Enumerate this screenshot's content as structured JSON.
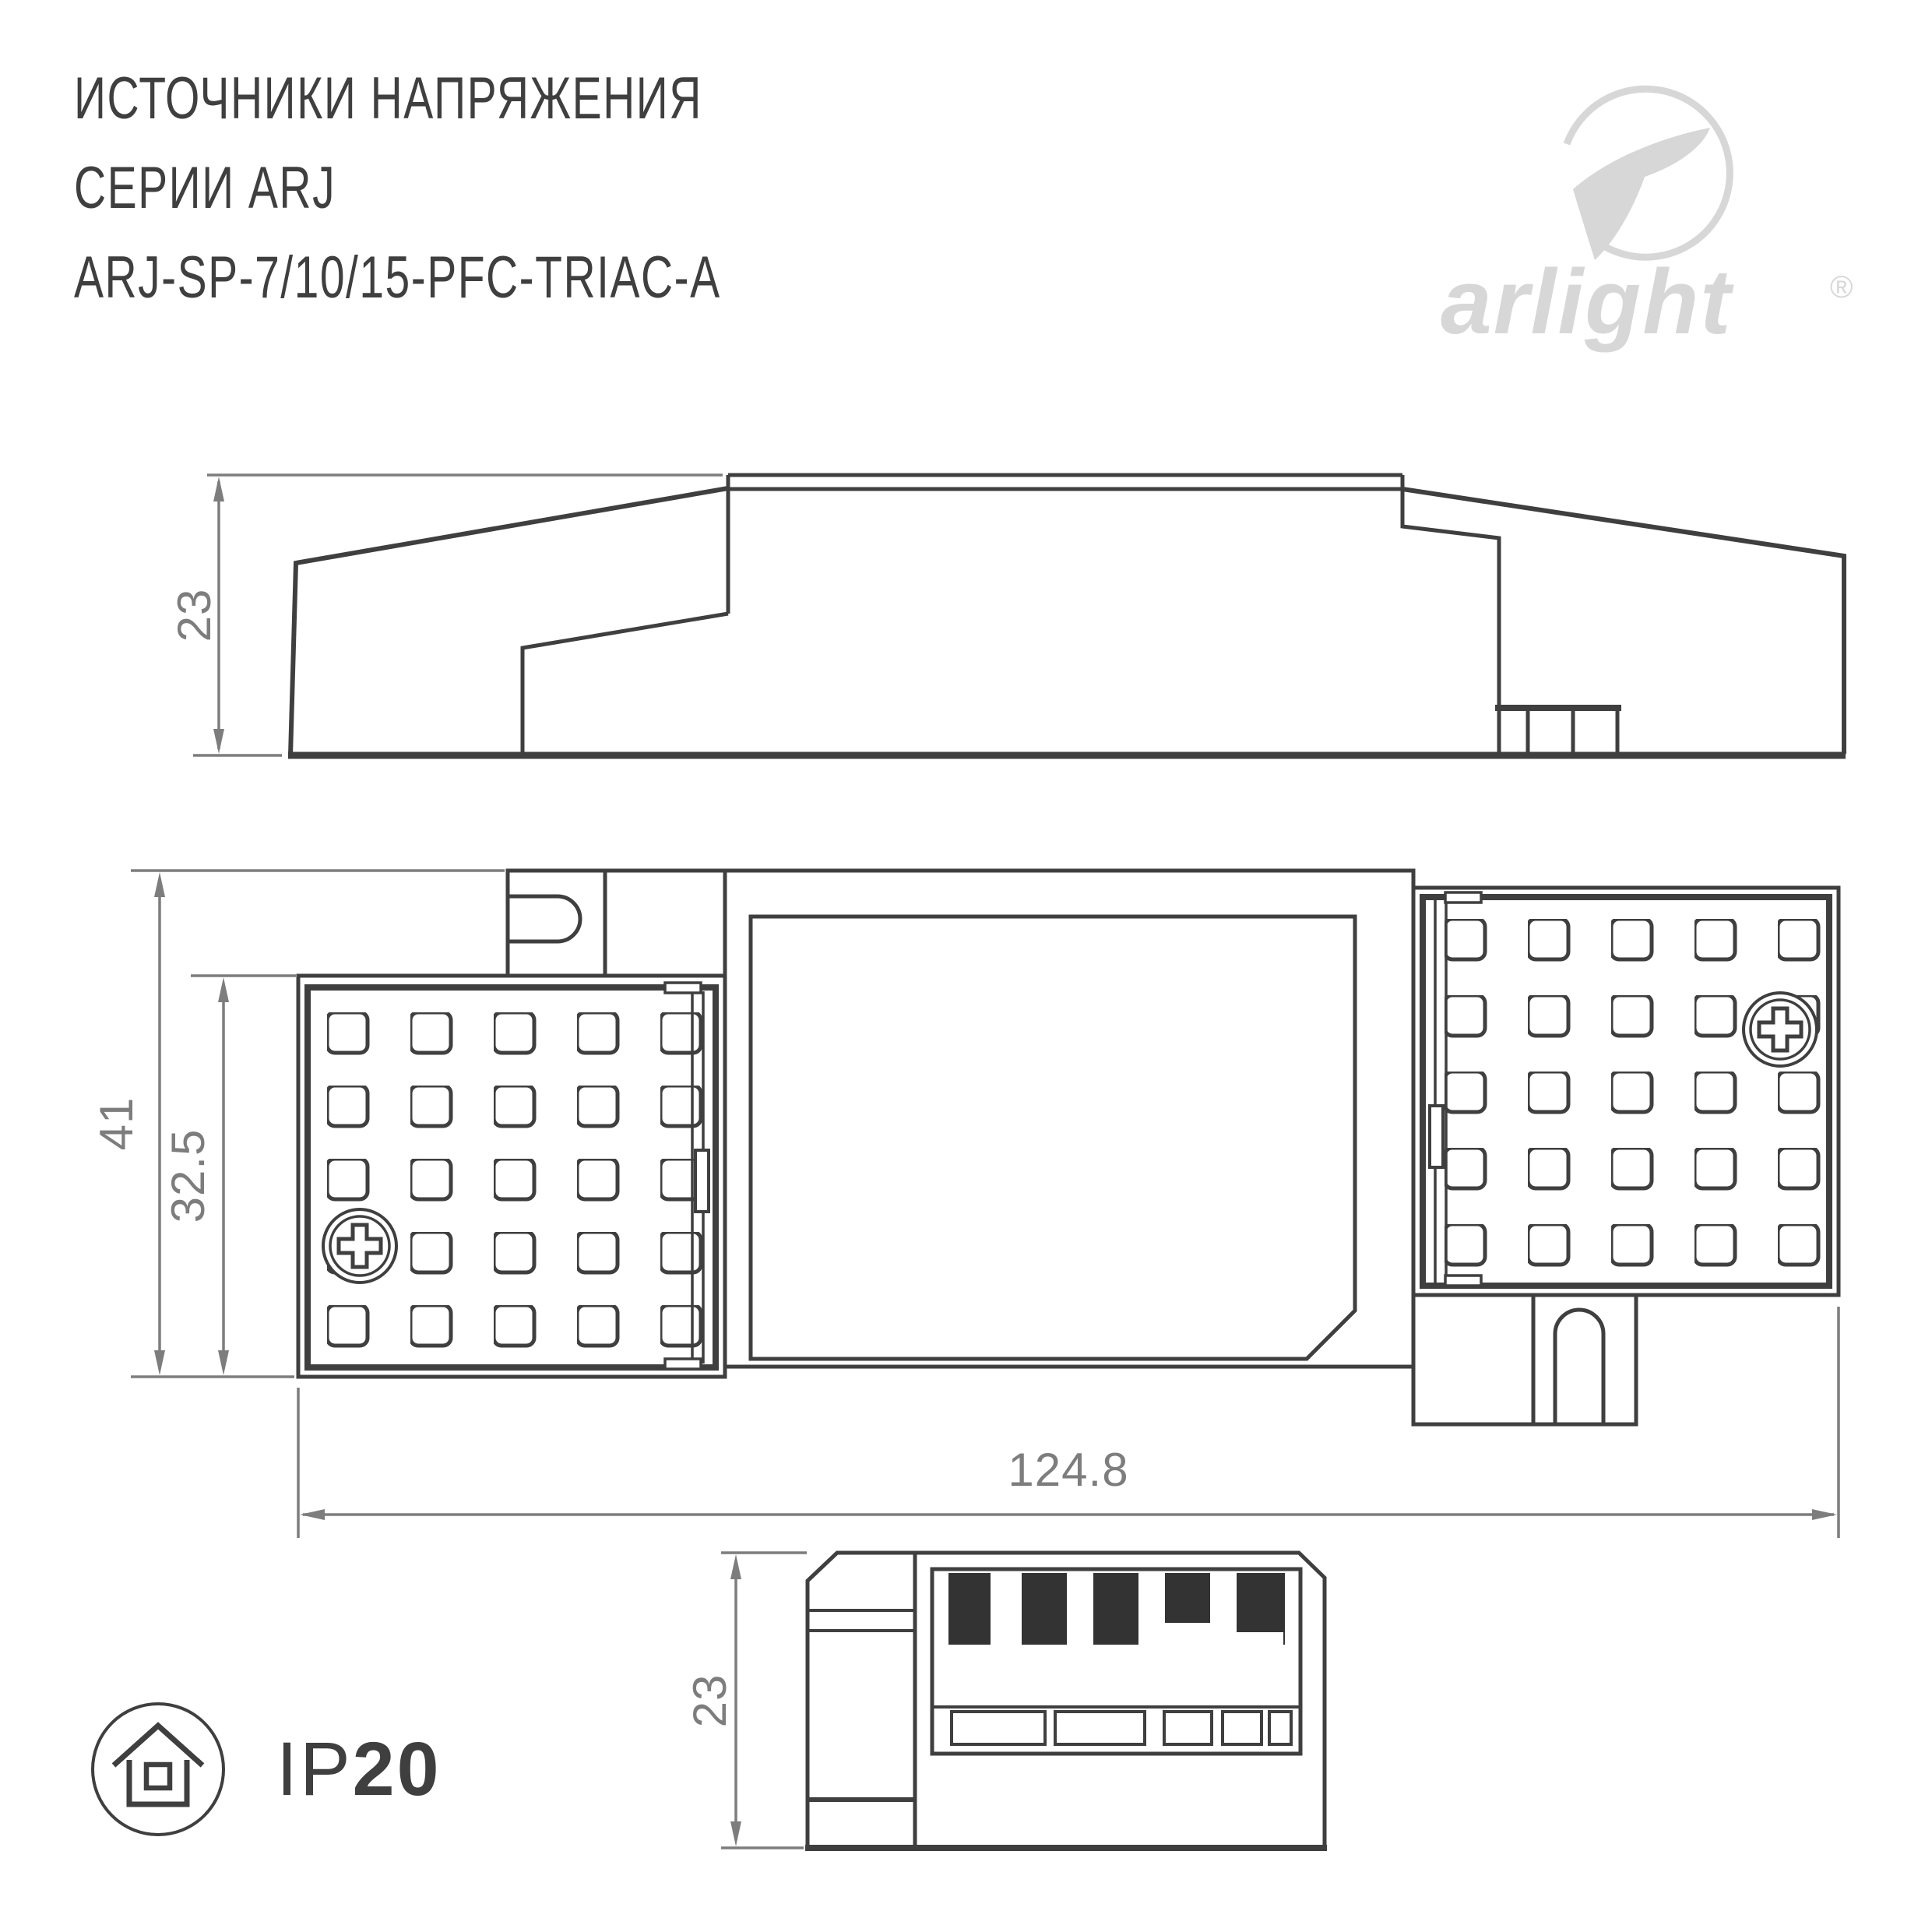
{
  "header": {
    "line1": "ИСТОЧНИКИ НАПРЯЖЕНИЯ",
    "line2": "СЕРИИ ARJ",
    "line3": "ARJ-SP-7/10/15-PFC-TRIAC-A"
  },
  "logo": {
    "wordmark": "arlight",
    "registered": "®",
    "symbol": "arlight-swoosh-icon",
    "color": "#d7d7d7"
  },
  "drawings": {
    "side_view": {
      "height_mm": "23"
    },
    "plan_view": {
      "overall_height_mm": "41",
      "cover_height_mm": "32.5",
      "width_mm": "124.8"
    },
    "end_view": {
      "height_mm": "23"
    }
  },
  "badge": {
    "ip_prefix": "IP",
    "ip_value": "20",
    "icon": "house-in-circle-icon"
  },
  "colors": {
    "line": "#3f3f3f",
    "dimension": "#7d7d7d",
    "logo": "#d7d7d7",
    "background": "#ffffff"
  }
}
